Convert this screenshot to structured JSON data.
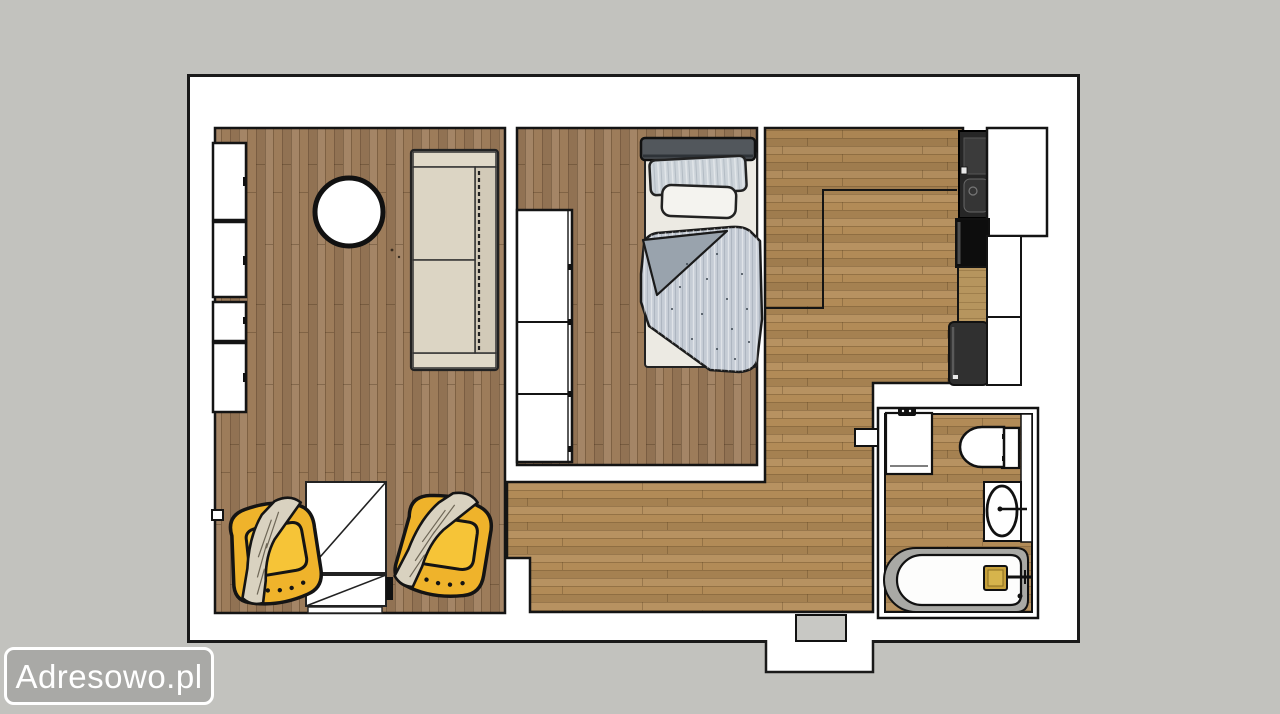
{
  "watermark": {
    "label": "Adresowo.pl"
  },
  "colors": {
    "bg": "#c2c2be",
    "plan-bg": "#ffffff",
    "outline": "#1a1a1a",
    "wood-v": "#9d7c5a",
    "wood-h": "#b28b57",
    "wood-counter": "#b6955e",
    "yellow": "#efb32b",
    "yellow-light": "#f6c437",
    "sofa": "#d7d0bf",
    "sofa-light": "#e0d9c8",
    "blanket": "#d9d2c0",
    "duvet": "#c5ccd5",
    "duvet-dark": "#99a3ad",
    "pillow-striped": "#ccd3d9",
    "headboard": "#52575c",
    "tub": "#a9a9a5",
    "gold": "#c7a13b",
    "appliance": "#262626",
    "mat": "#c8c8c4",
    "watermark-bg": "#a9a9a6",
    "watermark-border": "#ffffff",
    "watermark-text": "#ffffff"
  },
  "furniture_items": [
    "wall-wardrobe",
    "round-table",
    "sofa",
    "desk",
    "armchair-left",
    "armchair-right",
    "bedroom-wardrobe",
    "bed",
    "kitchen-sink-unit",
    "tall-cabinet",
    "cooktop",
    "counter-worktop",
    "kitchen-appliance",
    "base-cabinet",
    "washing-machine",
    "toilet",
    "washbasin",
    "bathtub",
    "entrance-mat"
  ]
}
